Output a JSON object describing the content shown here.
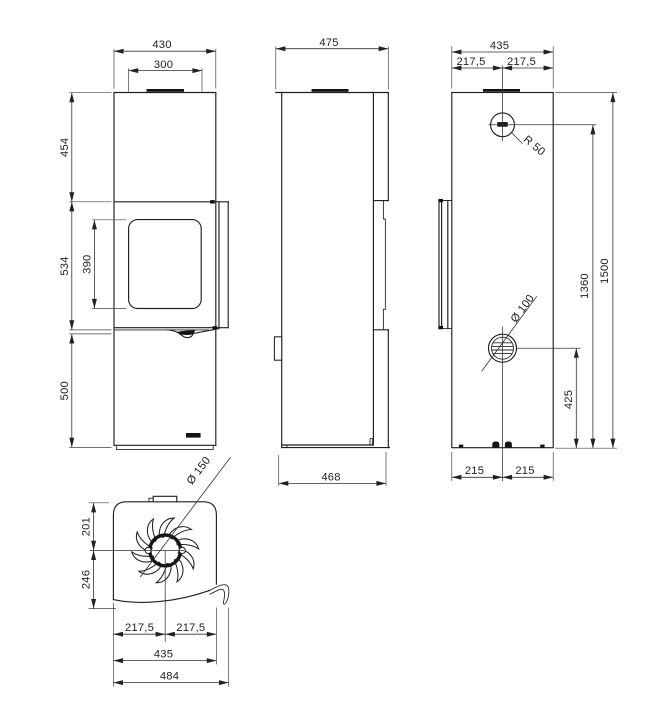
{
  "drawing": {
    "front": {
      "width": "430",
      "top_width": "300",
      "upper_height": "454",
      "door_height": "534",
      "window_height": "390",
      "base_height": "500"
    },
    "side": {
      "depth": "475",
      "base_depth": "468"
    },
    "rear": {
      "width": "435",
      "half_width_left": "217,5",
      "half_width_right": "217,5",
      "flue_radius": "R 50",
      "flue_center_height": "1360",
      "total_height": "1500",
      "intake_diameter": "Ø 100",
      "intake_center_height": "425",
      "foot_spacing_left": "215",
      "foot_spacing_right": "215"
    },
    "top": {
      "flue_diameter": "Ø 150",
      "flue_offset_back": "201",
      "flue_offset_front": "246",
      "half_width_left": "217,5",
      "half_width_right": "217,5",
      "body_width": "435",
      "base_width": "484"
    }
  }
}
